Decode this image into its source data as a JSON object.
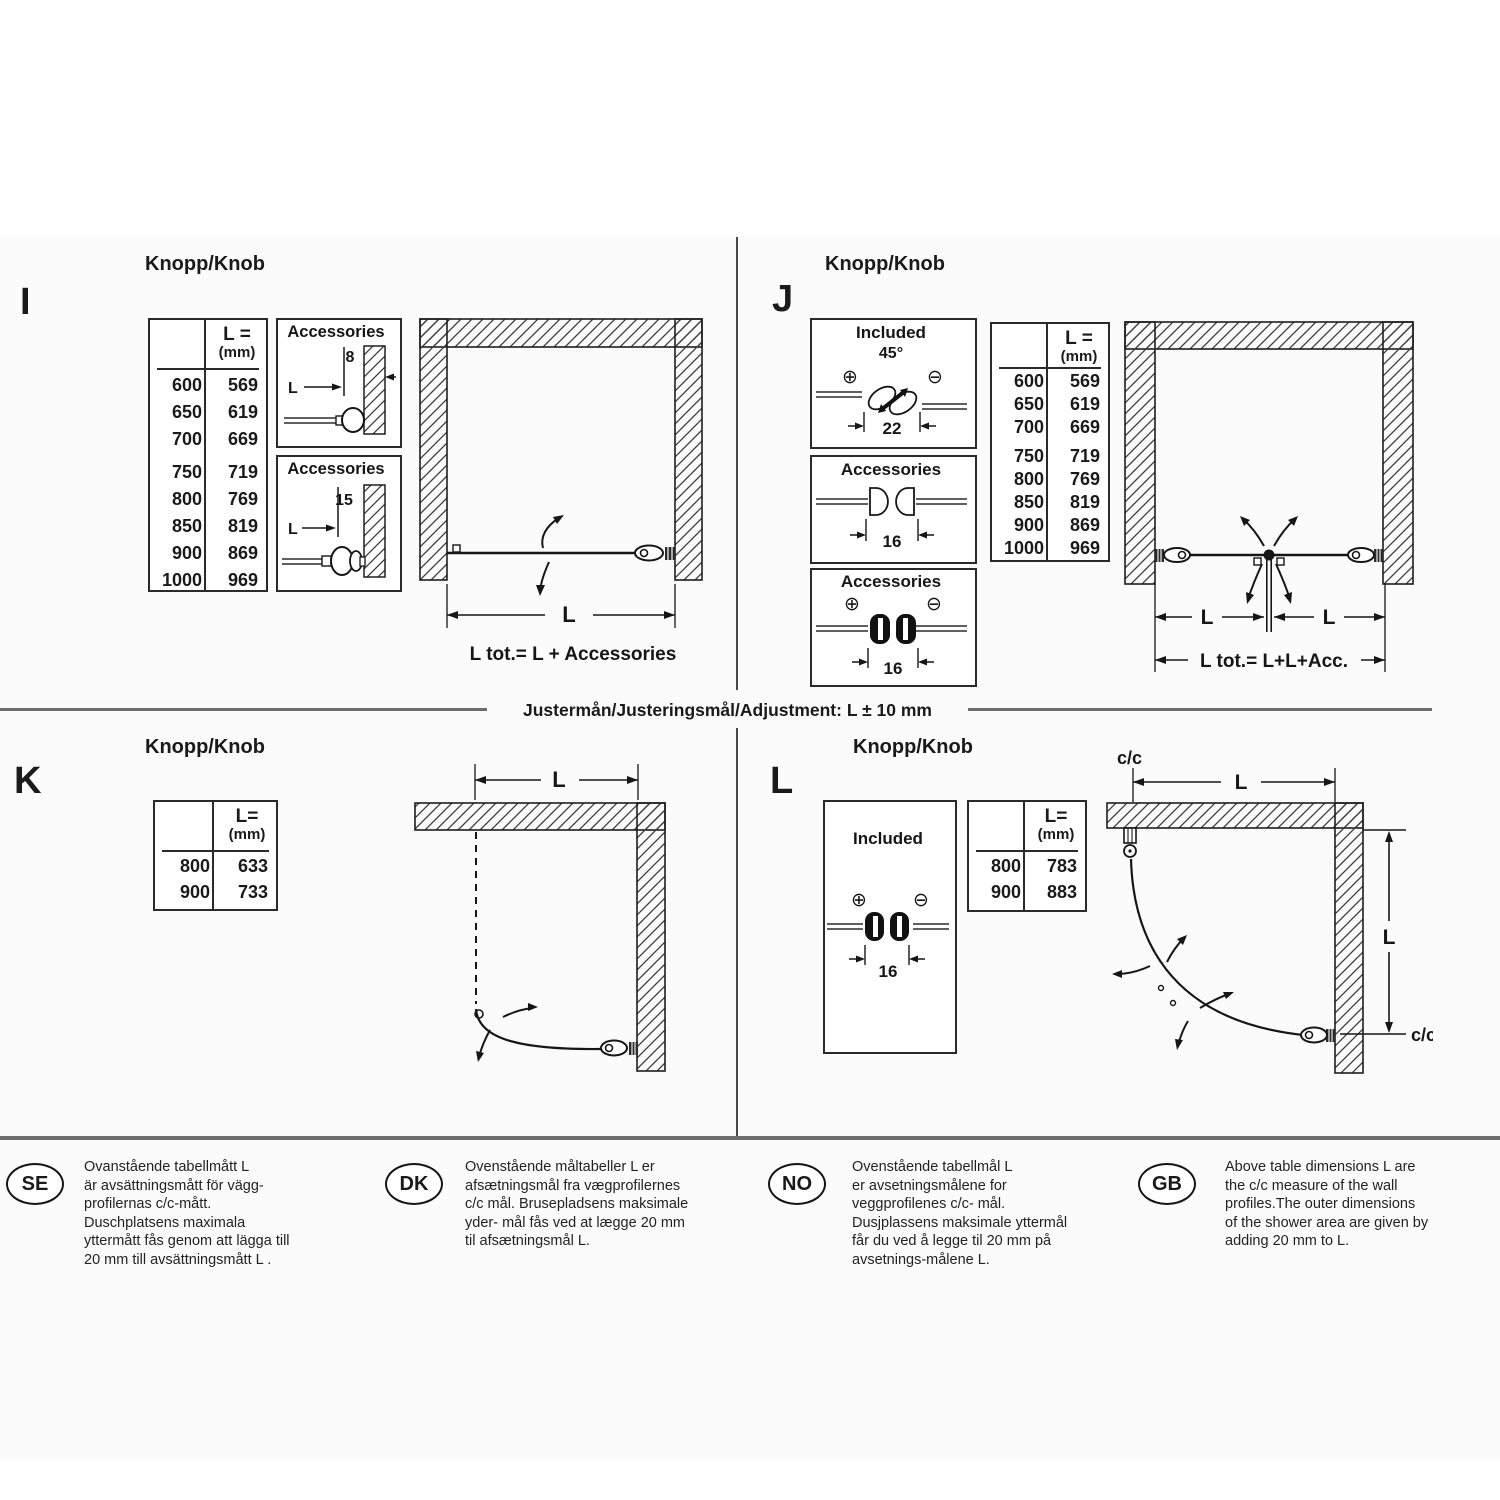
{
  "colors": {
    "ink": "#1a1a1a",
    "rule_gray": "#6e6e6e",
    "paper": "#fbfbfb"
  },
  "adjustment": {
    "label": "Justermån/Justeringsmål/Adjustment: L ± 10 mm"
  },
  "sections": {
    "i": {
      "letter": "I",
      "heading": "Knopp/Knob",
      "table": {
        "h1": "L =",
        "h2": "(mm)",
        "rows": [
          [
            "600",
            "569"
          ],
          [
            "650",
            "619"
          ],
          [
            "700",
            "669"
          ],
          [
            "750",
            "719"
          ],
          [
            "800",
            "769"
          ],
          [
            "850",
            "819"
          ],
          [
            "900",
            "869"
          ],
          [
            "1000",
            "969"
          ]
        ]
      },
      "acc1": {
        "title": "Accessories",
        "offset": "8",
        "dim": "L"
      },
      "acc2": {
        "title": "Accessories",
        "offset": "15",
        "dim": "L"
      },
      "diagram": {
        "dim": "L",
        "total": "L tot.= L + Accessories"
      }
    },
    "j": {
      "letter": "J",
      "heading": "Knopp/Knob",
      "included": {
        "title": "Included",
        "angle": "45°",
        "plus": "⊕",
        "minus": "⊖",
        "width": "22"
      },
      "acc1": {
        "title": "Accessories",
        "width": "16"
      },
      "acc2": {
        "title": "Accessories",
        "plus": "⊕",
        "minus": "⊖",
        "width": "16"
      },
      "table": {
        "h1": "L =",
        "h2": "(mm)",
        "rows": [
          [
            "600",
            "569"
          ],
          [
            "650",
            "619"
          ],
          [
            "700",
            "669"
          ],
          [
            "750",
            "719"
          ],
          [
            "800",
            "769"
          ],
          [
            "850",
            "819"
          ],
          [
            "900",
            "869"
          ],
          [
            "1000",
            "969"
          ]
        ]
      },
      "diagram": {
        "dim_left": "L",
        "dim_right": "L",
        "total": "L tot.= L+L+Acc."
      }
    },
    "k": {
      "letter": "K",
      "heading": "Knopp/Knob",
      "table": {
        "h1": "L=",
        "h2": "(mm)",
        "rows": [
          [
            "800",
            "633"
          ],
          [
            "900",
            "733"
          ]
        ]
      },
      "diagram": {
        "dim": "L"
      }
    },
    "l": {
      "letter": "L",
      "heading": "Knopp/Knob",
      "included": {
        "title": "Included",
        "plus": "⊕",
        "minus": "⊖",
        "width": "16"
      },
      "table": {
        "h1": "L=",
        "h2": "(mm)",
        "rows": [
          [
            "800",
            "783"
          ],
          [
            "900",
            "883"
          ]
        ]
      },
      "diagram": {
        "cc_top": "c/c",
        "dim_top": "L",
        "dim_right": "L",
        "cc_bottom": "c/c"
      }
    }
  },
  "footer": {
    "notes": [
      {
        "code": "SE",
        "lines": [
          "Ovanstående tabellmått L",
          "är avsättningsmått för vägg-",
          "profilernas c/c-mått.",
          "Duschplatsens maximala",
          "yttermått fås genom att lägga till",
          "20 mm till avsättningsmått L ."
        ]
      },
      {
        "code": "DK",
        "lines": [
          "Ovenstående måltabeller L er",
          "afsætningsmål fra vægprofilernes",
          "c/c mål. Brusepladsens maksimale",
          "yder- mål fås ved at lægge 20 mm",
          "til afsætningsmål L.",
          ""
        ]
      },
      {
        "code": "NO",
        "lines": [
          "Ovenstående tabellmål L",
          "er avsetningsmålene for",
          "veggprofilenes c/c- mål.",
          "Dusjplassens maksimale yttermål",
          "får du ved å legge til 20 mm på",
          "avsetnings-målene L."
        ]
      },
      {
        "code": "GB",
        "lines": [
          "Above table dimensions L are",
          "the c/c measure of the wall",
          "profiles.The outer dimensions",
          "of the shower area are given by",
          "adding 20 mm to L.",
          ""
        ]
      }
    ]
  }
}
